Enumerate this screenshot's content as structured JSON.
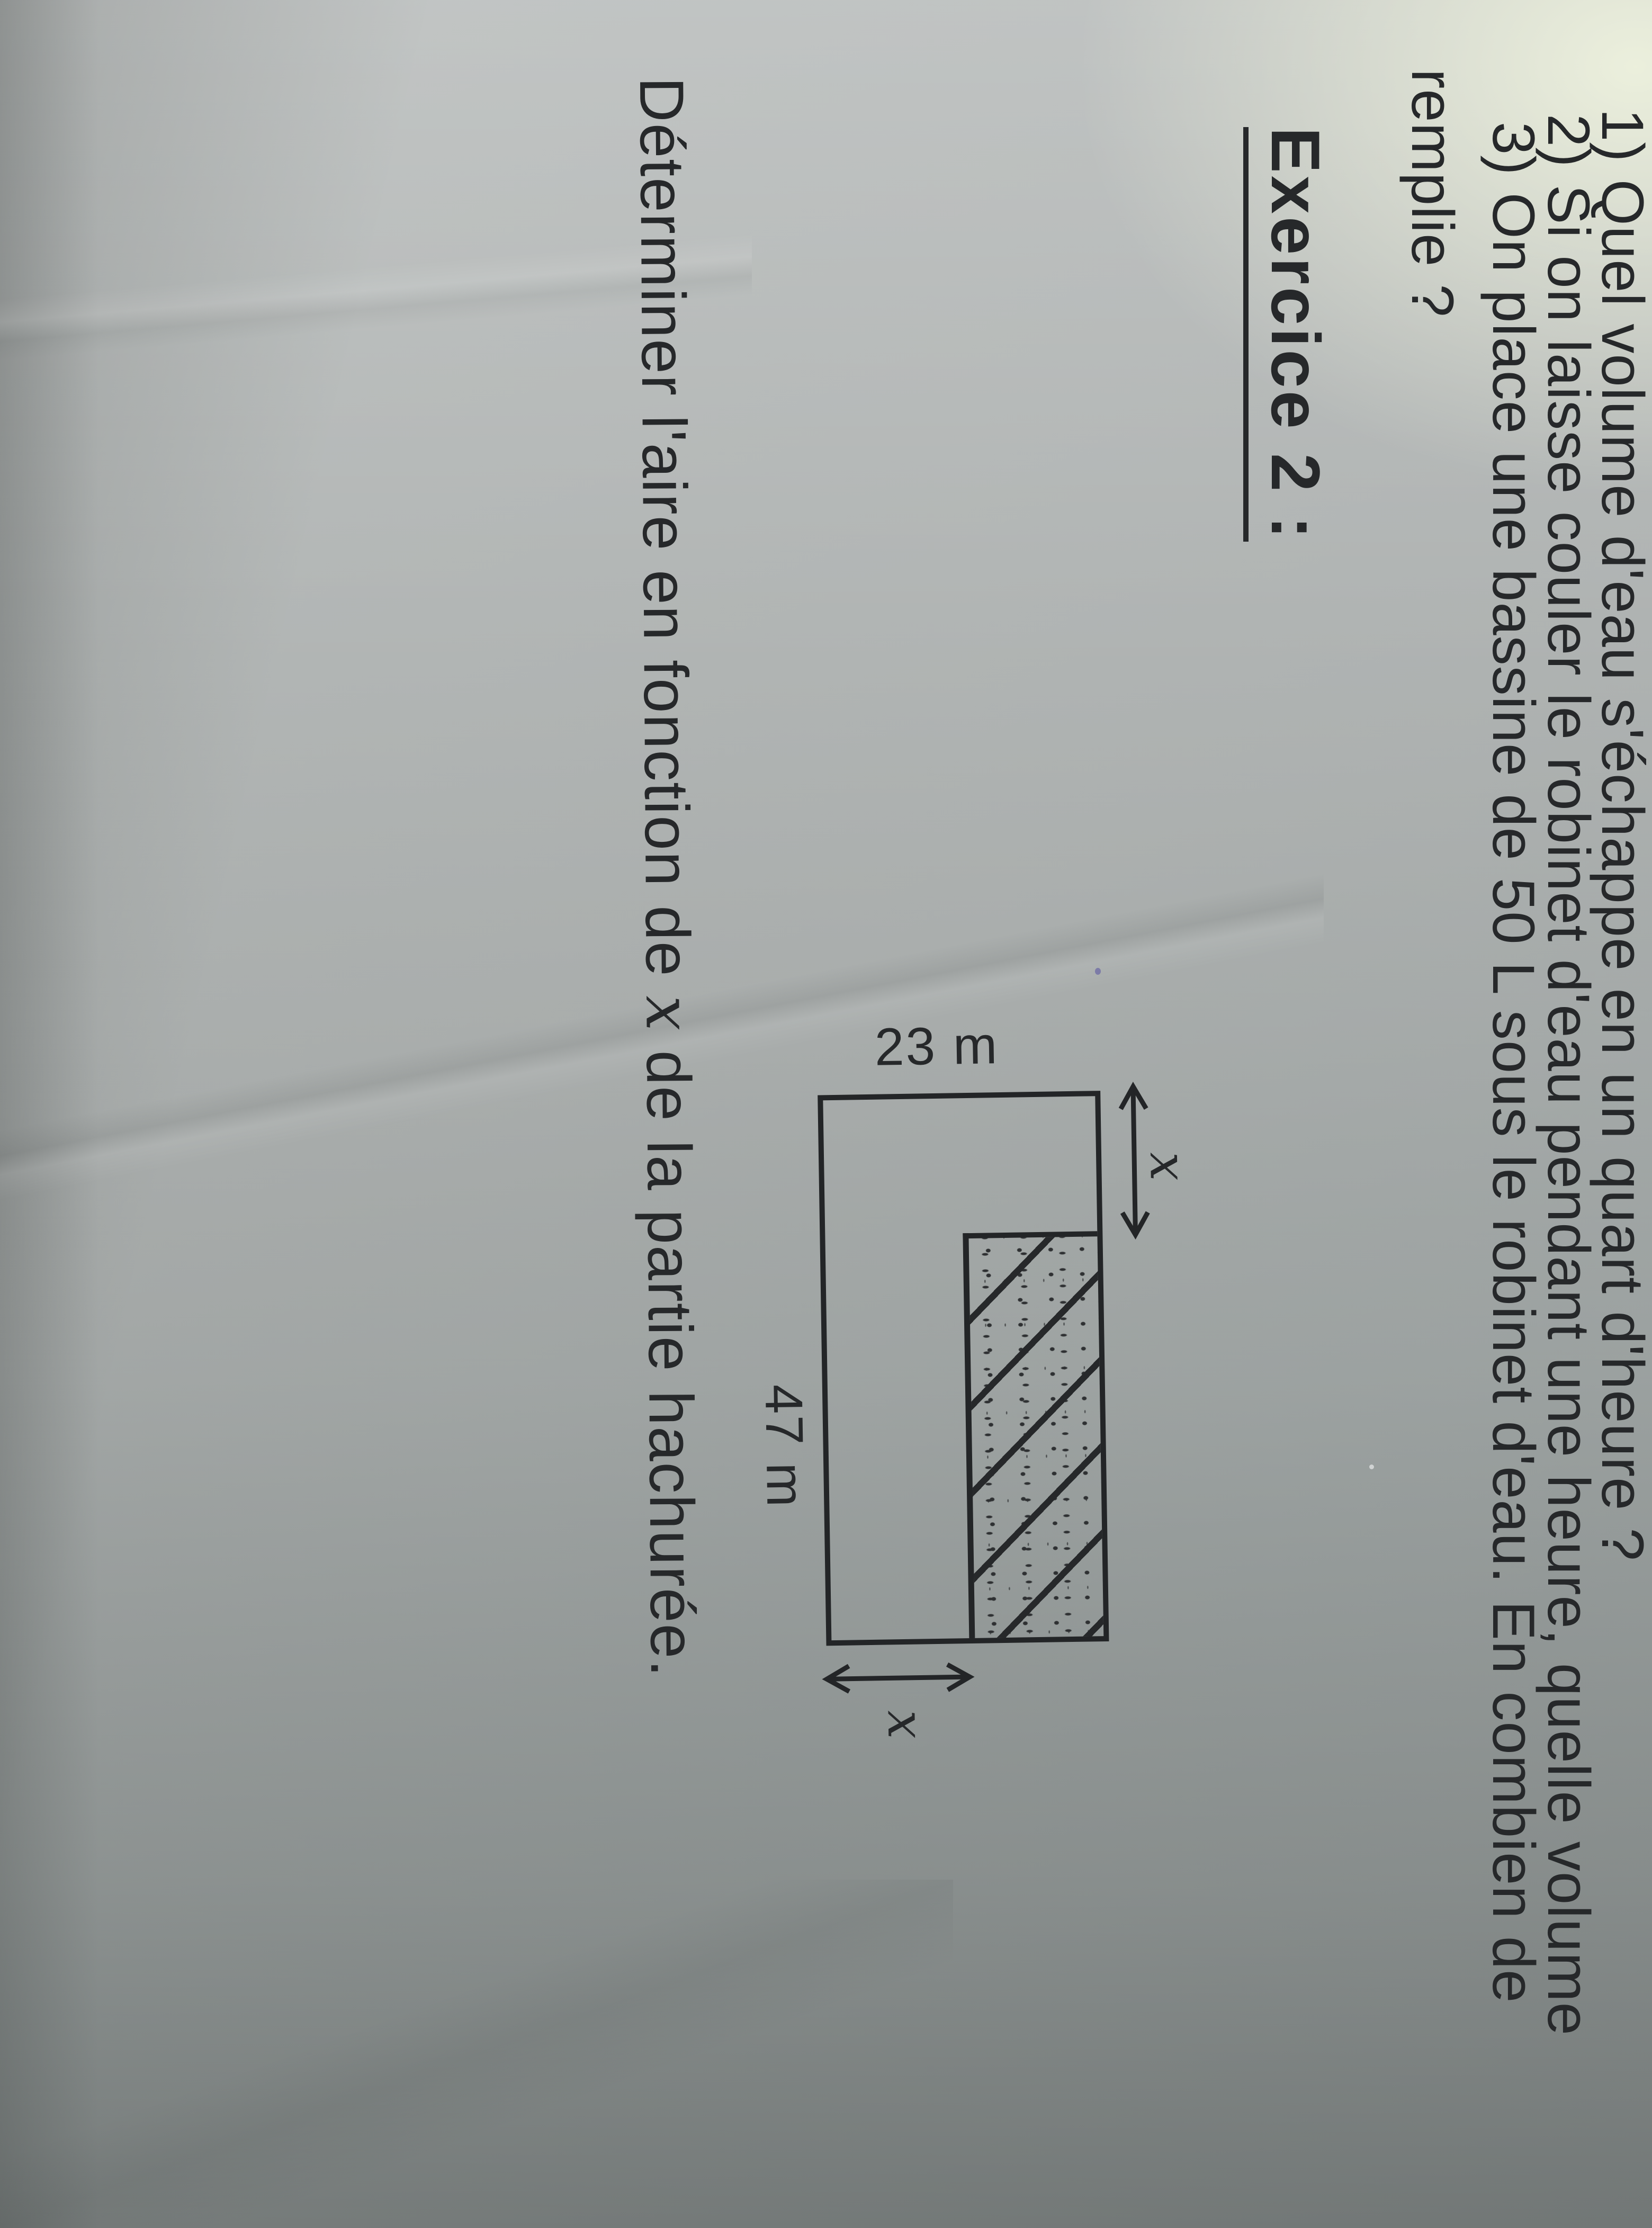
{
  "document": {
    "problem_list": {
      "line1": "1) Quel volume d'eau s'échappe en un quart d'heure ?",
      "line2": "2) Si on laisse couler le robinet d'eau pendant une heure, quelle volume",
      "line3": "3) On place une bassine de 50 L sous le robinet d'eau. En combien de",
      "line3_wrap": "remplie ?"
    },
    "heading": "Exercice 2 :",
    "question": {
      "pre": "Déterminer l'aire en fonction de ",
      "var": "x",
      "post": " de la partie hachurée."
    },
    "figure": {
      "side_short_label": "23 m",
      "side_long_label": "47 m",
      "gap_top_label": "x",
      "gap_right_label": "x"
    },
    "colors": {
      "ink": "#26282a",
      "paper": "#abafae",
      "glare": "#eef2de"
    }
  }
}
